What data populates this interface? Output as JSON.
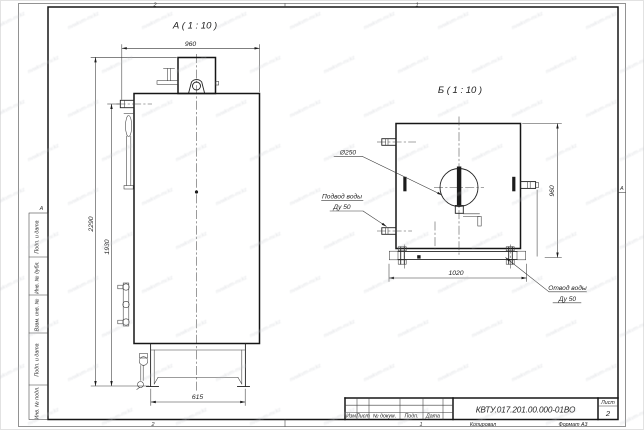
{
  "sheet": {
    "zone_top": [
      "2",
      "1"
    ],
    "zone_bottom": [
      "2",
      "1"
    ],
    "zone_left": "А",
    "zone_right": "А",
    "side_strip": [
      "Подп. и дата",
      "Инв. № дубл.",
      "Взам. инв. №",
      "Подп. и дата",
      "Инв. № подл."
    ],
    "footer": {
      "kopiroval": "Копировал",
      "format": "Формат А3"
    }
  },
  "title_block": {
    "designation": "КВТУ.017.201.00.000-01ВО",
    "sheet_label": "Лист",
    "sheet_number": "2",
    "columns": [
      "Изм",
      "Лист",
      "№ докум.",
      "Подп.",
      "Дата"
    ]
  },
  "view_a": {
    "label": "А ( 1 : 10 )",
    "dim_width": "960",
    "dim_height_total": "2290",
    "dim_height_body": "1930",
    "dim_base": "615"
  },
  "view_b": {
    "label": "Б ( 1 : 10 )",
    "dim_height": "960",
    "dim_width": "1020",
    "dim_hole": "Ø250",
    "label_inlet_1": "Подвод воды",
    "label_inlet_2": "Ду 50",
    "label_outlet_1": "Отвод воды",
    "label_outlet_2": "Ду 50"
  },
  "watermark": {
    "legible": false,
    "placeholder": "nvwkvm-nv.kz",
    "color": "#c2c6cc"
  }
}
